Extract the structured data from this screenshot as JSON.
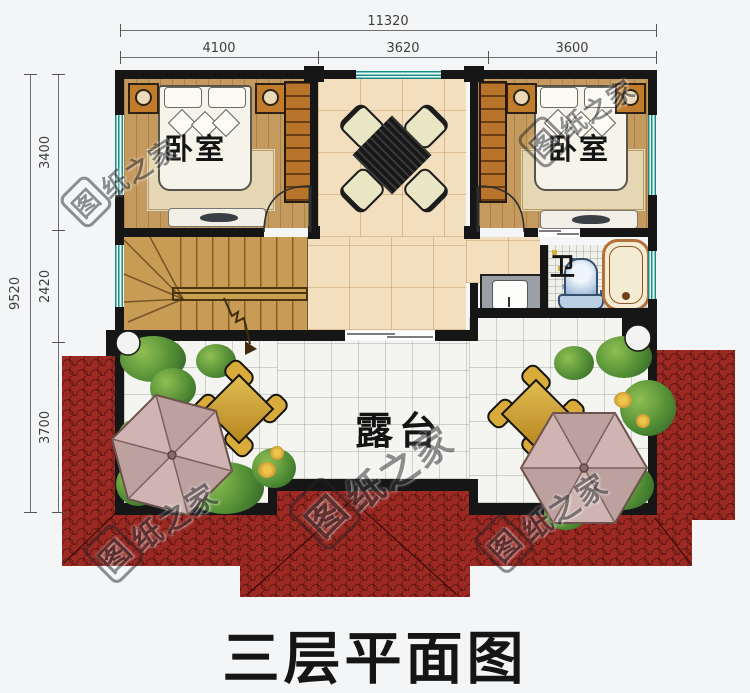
{
  "title": "三层平面图",
  "watermark": {
    "boxed_char": "图",
    "rest": "纸之家",
    "full": "图纸之家"
  },
  "dimensions": {
    "top": {
      "total": "11320",
      "segments": [
        "4100",
        "3620",
        "3600"
      ]
    },
    "left": {
      "total": "9520",
      "segments": [
        "3400",
        "2420",
        "3700"
      ]
    }
  },
  "rooms": {
    "bedroom_left": "卧室",
    "bedroom_right": "卧室",
    "bathroom": "卫",
    "terrace": "露台"
  },
  "colors": {
    "wall": "#161616",
    "roof_red": "#9c2a23",
    "window_teal": "#1f8a82",
    "bedroom_floor": "#c59a5e",
    "hall_floor": "#f3dfbe",
    "stair_wood": "#c99c55",
    "terrace_tile": "#f4f4f1",
    "umbrella_pink": "#cfb4b2",
    "outdoor_table_gold": "#c89e2c",
    "plant_green": "#5a8f3c"
  }
}
